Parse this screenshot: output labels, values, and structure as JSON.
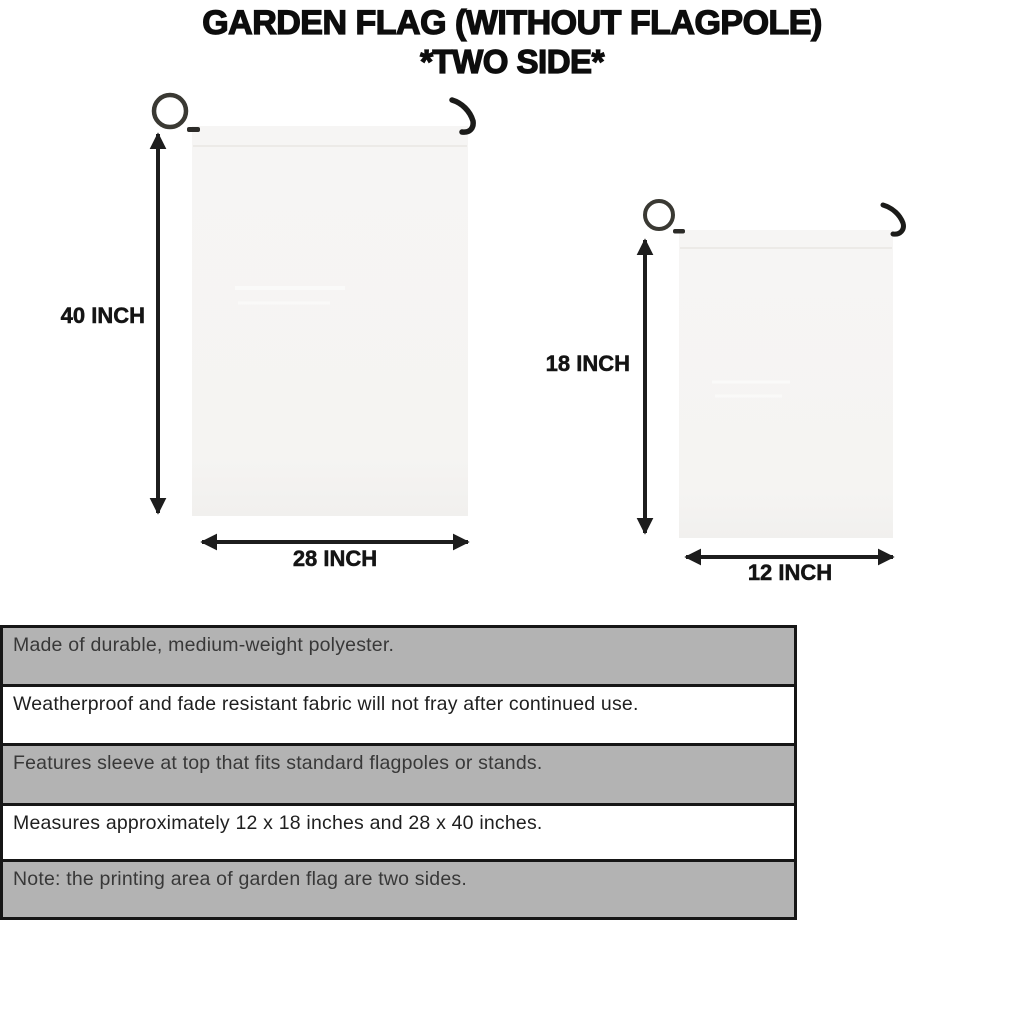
{
  "title": {
    "line1": "GARDEN FLAG (WITHOUT FLAGPOLE)",
    "line2": "*TWO SIDE*"
  },
  "flags": {
    "large": {
      "height_label": "40 INCH",
      "width_label": "28 INCH"
    },
    "small": {
      "height_label": "18 INCH",
      "width_label": "12 INCH"
    }
  },
  "features": [
    "Made of durable, medium-weight polyester.",
    "Weatherproof and fade resistant fabric will not fray after continued use.",
    "Features sleeve at top that fits standard flagpoles or stands.",
    "Measures approximately 12 x 18 inches and 28 x 40 inches.",
    "Note: the printing area of garden flag are two sides."
  ],
  "colors": {
    "background": "#ffffff",
    "row_gray": "#b3b3b3",
    "row_white": "#ffffff",
    "table_border": "#161616",
    "flag_fill": "#f6f5f3",
    "pole_dark": "#33322e",
    "arrow_black": "#1d1d1d",
    "title_text": "#0d0d0d"
  }
}
